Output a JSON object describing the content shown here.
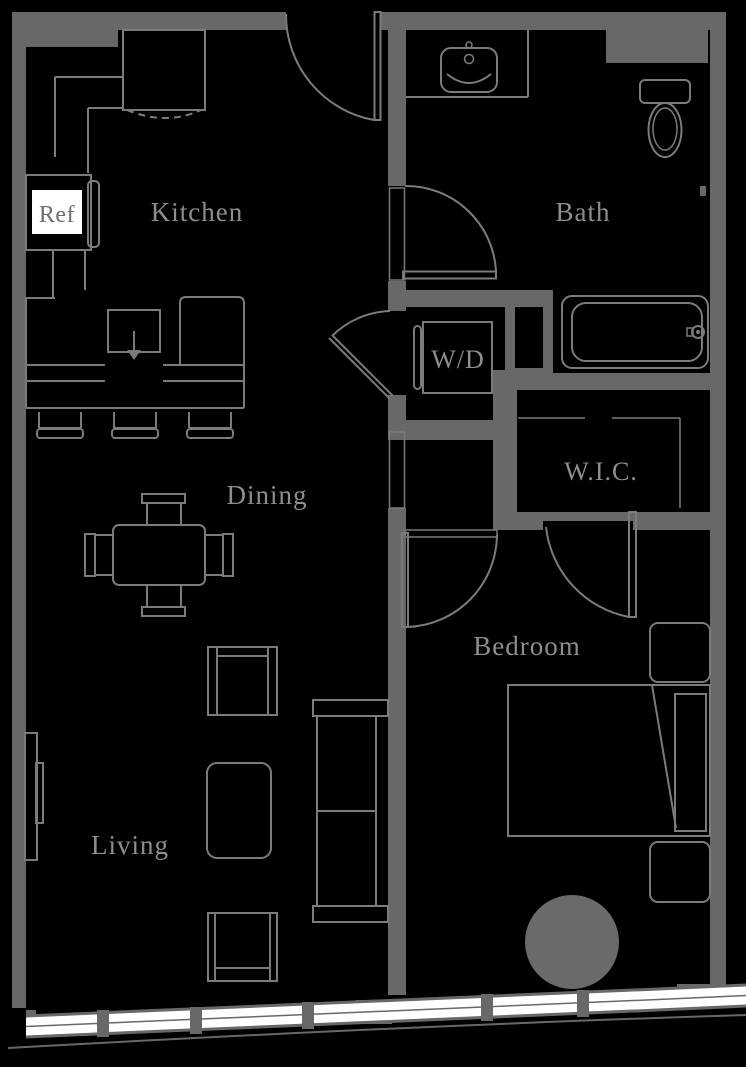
{
  "title": "One-bedroom apartment floor plan",
  "colors": {
    "background": "#000000",
    "wall": "#686868",
    "line": "#7b7b7b",
    "label": "#8e8e8e",
    "window_glass": "#ffffff",
    "ref_text": "#6d6d6d",
    "rug": "#6a6a6a"
  },
  "rooms": {
    "kitchen": {
      "label": "Kitchen"
    },
    "bath": {
      "label": "Bath"
    },
    "dining": {
      "label": "Dining"
    },
    "living": {
      "label": "Living"
    },
    "bedroom": {
      "label": "Bedroom"
    },
    "wic": {
      "label": "W.I.C."
    },
    "laundry": {
      "label": "W/D"
    }
  },
  "appliances": {
    "refrigerator": {
      "label": "Ref"
    }
  }
}
